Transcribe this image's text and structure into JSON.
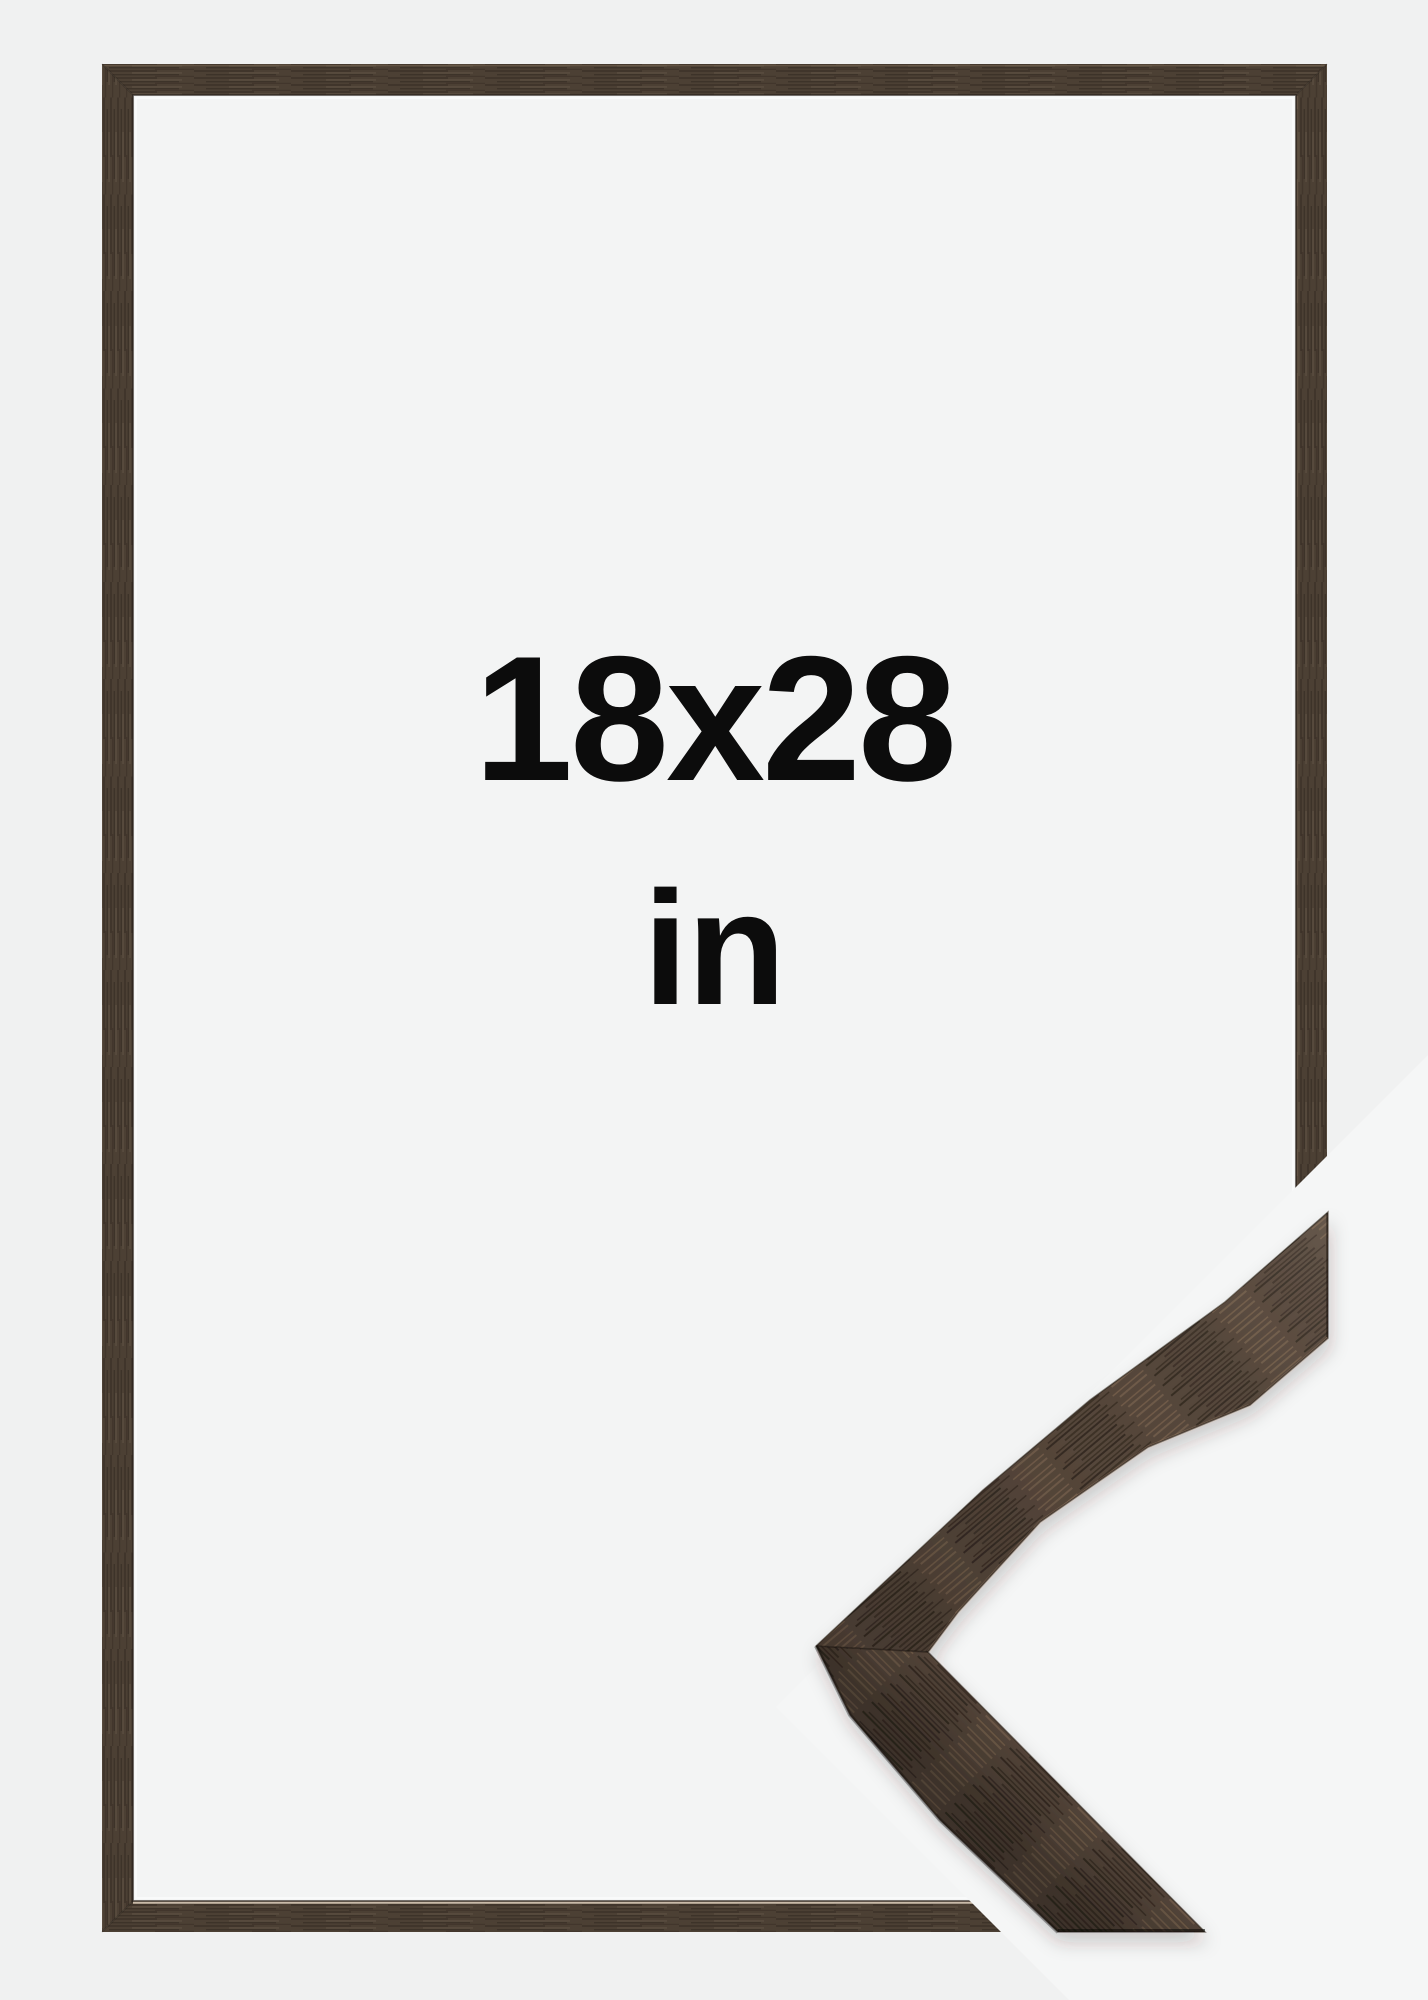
{
  "image": {
    "type": "product-photo",
    "subject": "brown walnut wooden picture frame shown empty with a mitered corner profile sample overlapping the bottom-right corner",
    "size_label": {
      "dimensions": "18x28",
      "unit": "in"
    }
  },
  "colors": {
    "bg": "#f0f1f1",
    "inner-bg": "#f3f4f4",
    "overlay-bg": "#f5f6f6",
    "text": "#0c0c0c",
    "wood-base": "#4c4034",
    "wood-dark": "#342b22",
    "wood-light": "#665645",
    "wood-sample-base": "#55463a",
    "wood-sample-dark": "#2e251d",
    "wood-sample-light": "#7d6751",
    "lip-highlight": "#dfd0bd",
    "edge-dark": "#2a221b"
  }
}
